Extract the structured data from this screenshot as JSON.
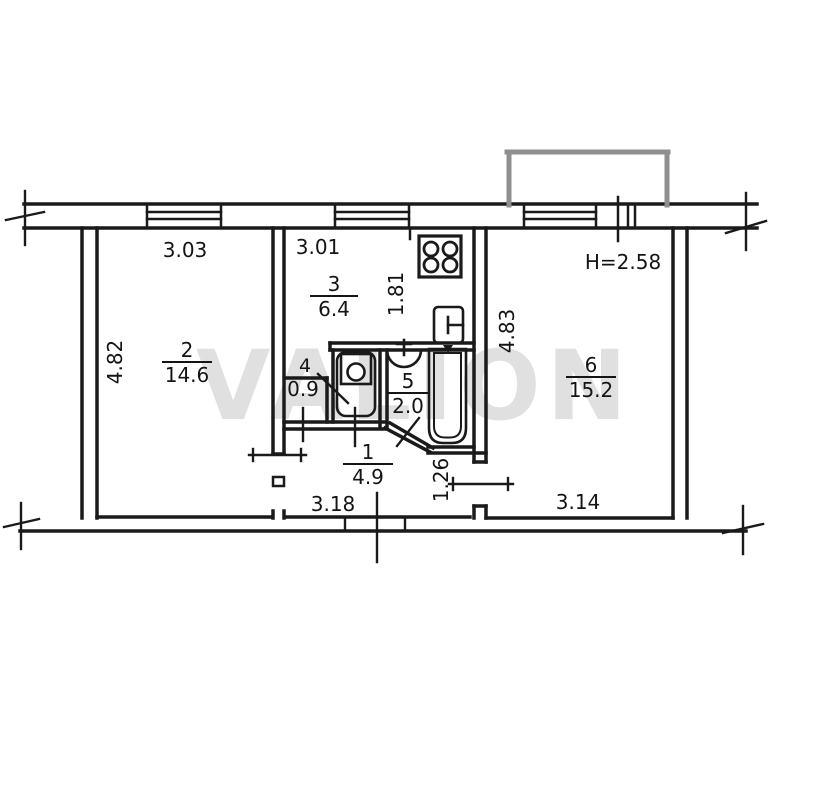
{
  "watermark": "VALION",
  "plan": {
    "ceiling_height_label": "H=2.58",
    "rooms": [
      {
        "number": "1",
        "area": "4.9"
      },
      {
        "number": "2",
        "area": "14.6"
      },
      {
        "number": "3",
        "area": "6.4"
      },
      {
        "number": "4",
        "area": "0.9"
      },
      {
        "number": "5",
        "area": "2.0"
      },
      {
        "number": "6",
        "area": "15.2"
      }
    ],
    "dimensions": {
      "room2_width": "3.03",
      "room2_depth": "4.82",
      "kitchen_width": "3.01",
      "kitchen_depth": "1.81",
      "room6_depth": "4.83",
      "room6_width": "3.14",
      "hall_width": "3.18",
      "hall_door_width": "1.26"
    },
    "fixtures": [
      "stove-icon",
      "kitchen-sink-icon",
      "toilet-icon",
      "washbasin-icon",
      "bathtub-icon",
      "balcony"
    ]
  }
}
